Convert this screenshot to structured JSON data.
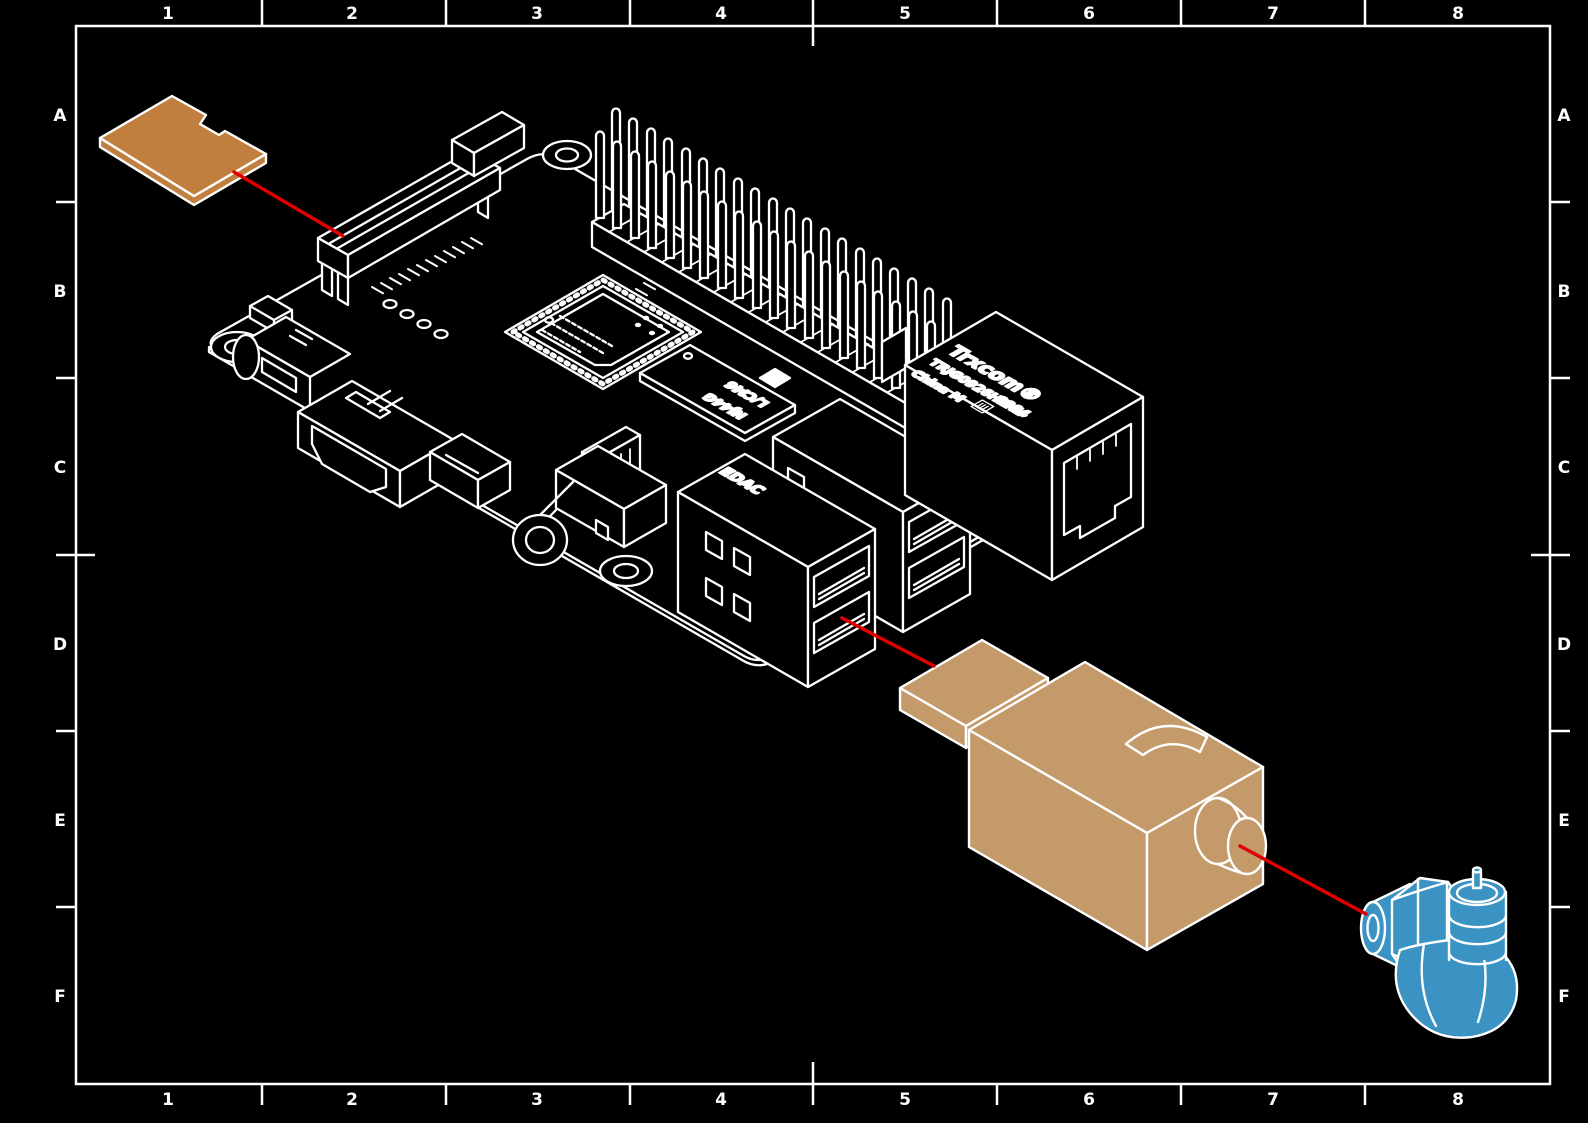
{
  "frame": {
    "columns": [
      "1",
      "2",
      "3",
      "4",
      "5",
      "6",
      "7",
      "8"
    ],
    "rows": [
      "A",
      "B",
      "C",
      "D",
      "E",
      "F"
    ]
  },
  "markings": {
    "ethernet": {
      "brand": "Trxcom®",
      "part_number": "TRJG0926HENL",
      "origin": "China M",
      "date_code": "1904"
    },
    "usb_connector": "EDAC",
    "ram": {
      "line1": "NJ44G",
      "line2": "L/CM6"
    }
  },
  "colors": {
    "background": "#000000",
    "line_art": "#FFFFFF",
    "leader_line": "#E10000",
    "sd_card": "#C07F3E",
    "usb_dongle": "#C49A6B",
    "sma_adapter": "#3B93C4"
  }
}
